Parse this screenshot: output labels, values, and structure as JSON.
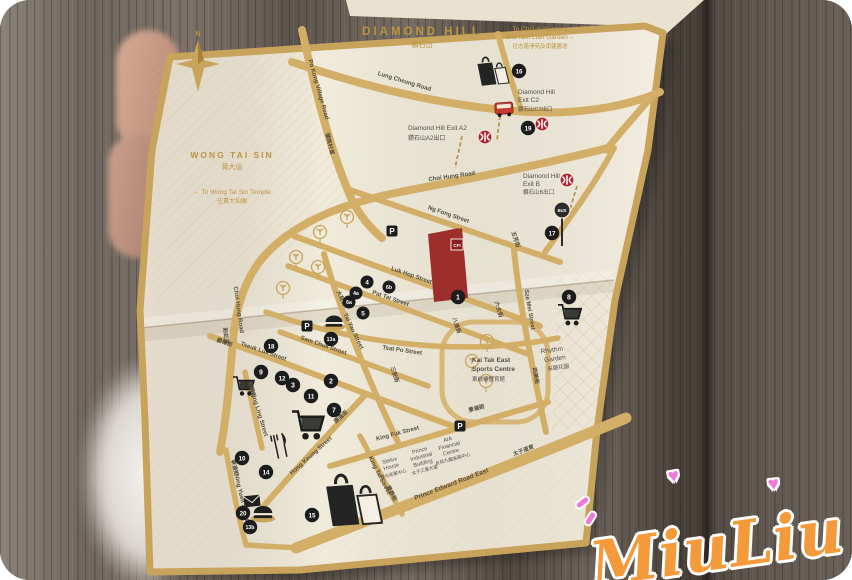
{
  "watermark": {
    "text": "MiuLiu",
    "heart": "♥"
  },
  "map": {
    "title": {
      "en": "DIAMOND HILL",
      "zh": "鑽石山"
    },
    "compass": {
      "north": "N"
    },
    "notes": {
      "chi_lin": {
        "line1": "To Chi Lin Nunnery",
        "line2": "and Nan Lian Garden→",
        "zh": "往志蓮淨苑及南蓮園池"
      },
      "wong_tai_sin_temple": {
        "en": "← To Wong Tai Sin Temple",
        "zh": "往黃大仙廟"
      }
    },
    "regions": {
      "wong_tai_sin": {
        "en": "WONG TAI SIN",
        "zh": "黃大仙"
      }
    },
    "exits": {
      "a2": {
        "en": "Diamond Hill Exit A2",
        "zh": "鑽石山A2出口"
      },
      "c2": {
        "line1": "Diamond Hill",
        "line2": "Exit C2",
        "zh": "鑽石山C2出口"
      },
      "b": {
        "line1": "Diamond Hill",
        "line2": "Exit B",
        "zh": "鑽石山B出口"
      }
    },
    "places": {
      "kai_tak": {
        "line1": "Kai Tak East",
        "line2": "Sports Centre",
        "zh": "東啟德體育館"
      },
      "rhythm_garden": {
        "line1": "Rhythm",
        "line2": "Garden",
        "zh": "采頤花園"
      },
      "stelux": {
        "line1": "Stelux",
        "line2": "House",
        "zh": "寶光商業中心"
      },
      "prince_industrial": {
        "line1": "Prince",
        "line2": "Industrial",
        "line3": "Building",
        "zh": "太子工業大廈"
      },
      "aia": {
        "line1": "AIA",
        "line2": "Financial",
        "line3": "Centre",
        "zh": "友邦九龍金融中心"
      }
    },
    "roads": {
      "lung_cheung": {
        "en": "Lung Cheung Road"
      },
      "po_kong": {
        "en": "Po Kong Village Road",
        "zh": "蒲崗村道"
      },
      "choi_hung": {
        "en": "Choi Hung Road",
        "zh": "彩虹道"
      },
      "ng_fong": {
        "en": "Ng Fong Street",
        "zh": "五芳街"
      },
      "luk_hop": {
        "en": "Luk Hop Street",
        "zh": "六合街"
      },
      "pat_tat": {
        "en": "Pat Tat Street",
        "zh": "八達街"
      },
      "tsat_po": {
        "en": "Tsat Po Street"
      },
      "sam_chuk": {
        "en": "Sam Chuk Street",
        "zh": "三祝街"
      },
      "tseuk_luk": {
        "en": "Tseuk Luk Street",
        "zh": "爵祿街"
      },
      "tai_yau": {
        "en": "Tai Yau Street",
        "zh": "大有街"
      },
      "sze_mei": {
        "en": "Sze Mei Street",
        "zh": "四美街"
      },
      "shung_ling": {
        "en": "Shung Ling Street",
        "zh": "崇齡街"
      },
      "king_tai": {
        "en": "King Tai Street",
        "zh": "景泰街"
      },
      "king_fuk": {
        "en": "King Fuk Street",
        "zh": "景福街"
      },
      "hong_keung": {
        "en": "Hong Keung Street",
        "zh": "康強街"
      },
      "ning_yuen": {
        "en": "Ning Yuen Street",
        "zh": "寧遠街"
      },
      "prince_edward": {
        "en": "Prince Edward Road East",
        "zh": "太子道東"
      }
    },
    "markers": {
      "m1": "1",
      "m2": "2",
      "m3": "3",
      "m4": "4",
      "m4a": "4a",
      "m5": "5",
      "m6a": "6a",
      "m6b": "6b",
      "m7": "7",
      "m8": "8",
      "m9": "9",
      "m10": "10",
      "m11": "11",
      "m12": "12",
      "m13a": "13a",
      "m13b": "13b",
      "m14": "14",
      "m15": "15",
      "m16": "16",
      "m17": "17",
      "m18": "18",
      "m19": "19",
      "m20": "20"
    },
    "signs": {
      "parking": "P",
      "bus": "BUS"
    },
    "landmark": {
      "logo": "CFI"
    },
    "colors": {
      "road_gold": "#d3ae66",
      "border_gold": "#c8a35c",
      "paper": "#f1ebdb",
      "marker_black": "#1c1c1c",
      "mtr_red": "#ac2430",
      "landmark_red": "#9e2e2c",
      "gold_text": "#bb9440",
      "signature_orange": "#f49a3a",
      "heart_pink": "#f178d6"
    }
  }
}
